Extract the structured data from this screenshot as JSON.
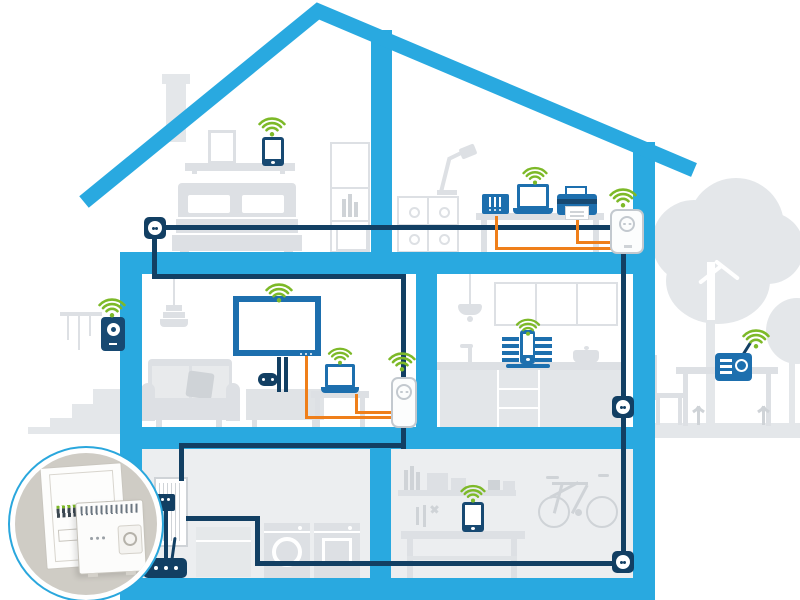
{
  "scene": {
    "type": "home-powerline-network-cutaway-illustration",
    "colors": {
      "structure_cyan": "#29a9e0",
      "cable_navy": "#123f63",
      "device_blue": "#1d6fae",
      "device_navy": "#174972",
      "wifi_green": "#7db928",
      "cable_orange": "#ef7f1a",
      "furniture_gray": "#dde0e4",
      "furniture_gray_dark": "#cfd3d7",
      "outdoor_gray": "#e4e7ea",
      "basement_bg": "#eceef0",
      "adapter_body": "#fcfdfd",
      "adapter_border": "#c3c9cf",
      "inset_bg": "#cfccc5",
      "inset_ring": "#2aa7dd"
    },
    "rooms": [
      {
        "name": "attic-bedroom",
        "devices": [
          "wifi-smartphone",
          "powerline-wall-socket",
          "bed",
          "wardrobe",
          "picture-frame",
          "chimney"
        ]
      },
      {
        "name": "home-office",
        "devices": [
          "desk-lamp",
          "nas-server",
          "wifi-laptop",
          "printer",
          "powerline-wifi-adapter",
          "desk",
          "cabinet"
        ]
      },
      {
        "name": "living-room",
        "devices": [
          "pendant-lamp",
          "sofa",
          "smart-tv",
          "game-console",
          "gamepad",
          "wifi-laptop",
          "powerline-wifi-adapter"
        ]
      },
      {
        "name": "kitchen",
        "devices": [
          "pendant-lamp",
          "wall-cabinets",
          "sink",
          "cooking-pot",
          "wifi-speaker-dock",
          "powerline-wall-socket"
        ]
      },
      {
        "name": "basement-utility-room",
        "devices": [
          "fuse-box",
          "din-rail-powerline-adapter",
          "wifi-router",
          "washing-machine",
          "dryer"
        ]
      },
      {
        "name": "basement-workshop",
        "devices": [
          "wall-shelf",
          "wifi-tablet",
          "workbench",
          "tools",
          "bicycle",
          "powerline-wall-socket"
        ]
      },
      {
        "name": "outdoors",
        "devices": [
          "wifi-door-intercom",
          "garden-steps",
          "wind-chime",
          "large-tree",
          "small-tree",
          "garden-table",
          "garden-chair",
          "wifi-radio",
          "plants"
        ]
      }
    ],
    "inset": {
      "name": "fuse-box-closeup",
      "content": "fuse box with circuit breakers and DIN-rail powerline adapter"
    },
    "wifi_hotspots_count": 10,
    "powerline_wall_sockets_count": 3,
    "powerline_plug_adapters_count": 2
  }
}
